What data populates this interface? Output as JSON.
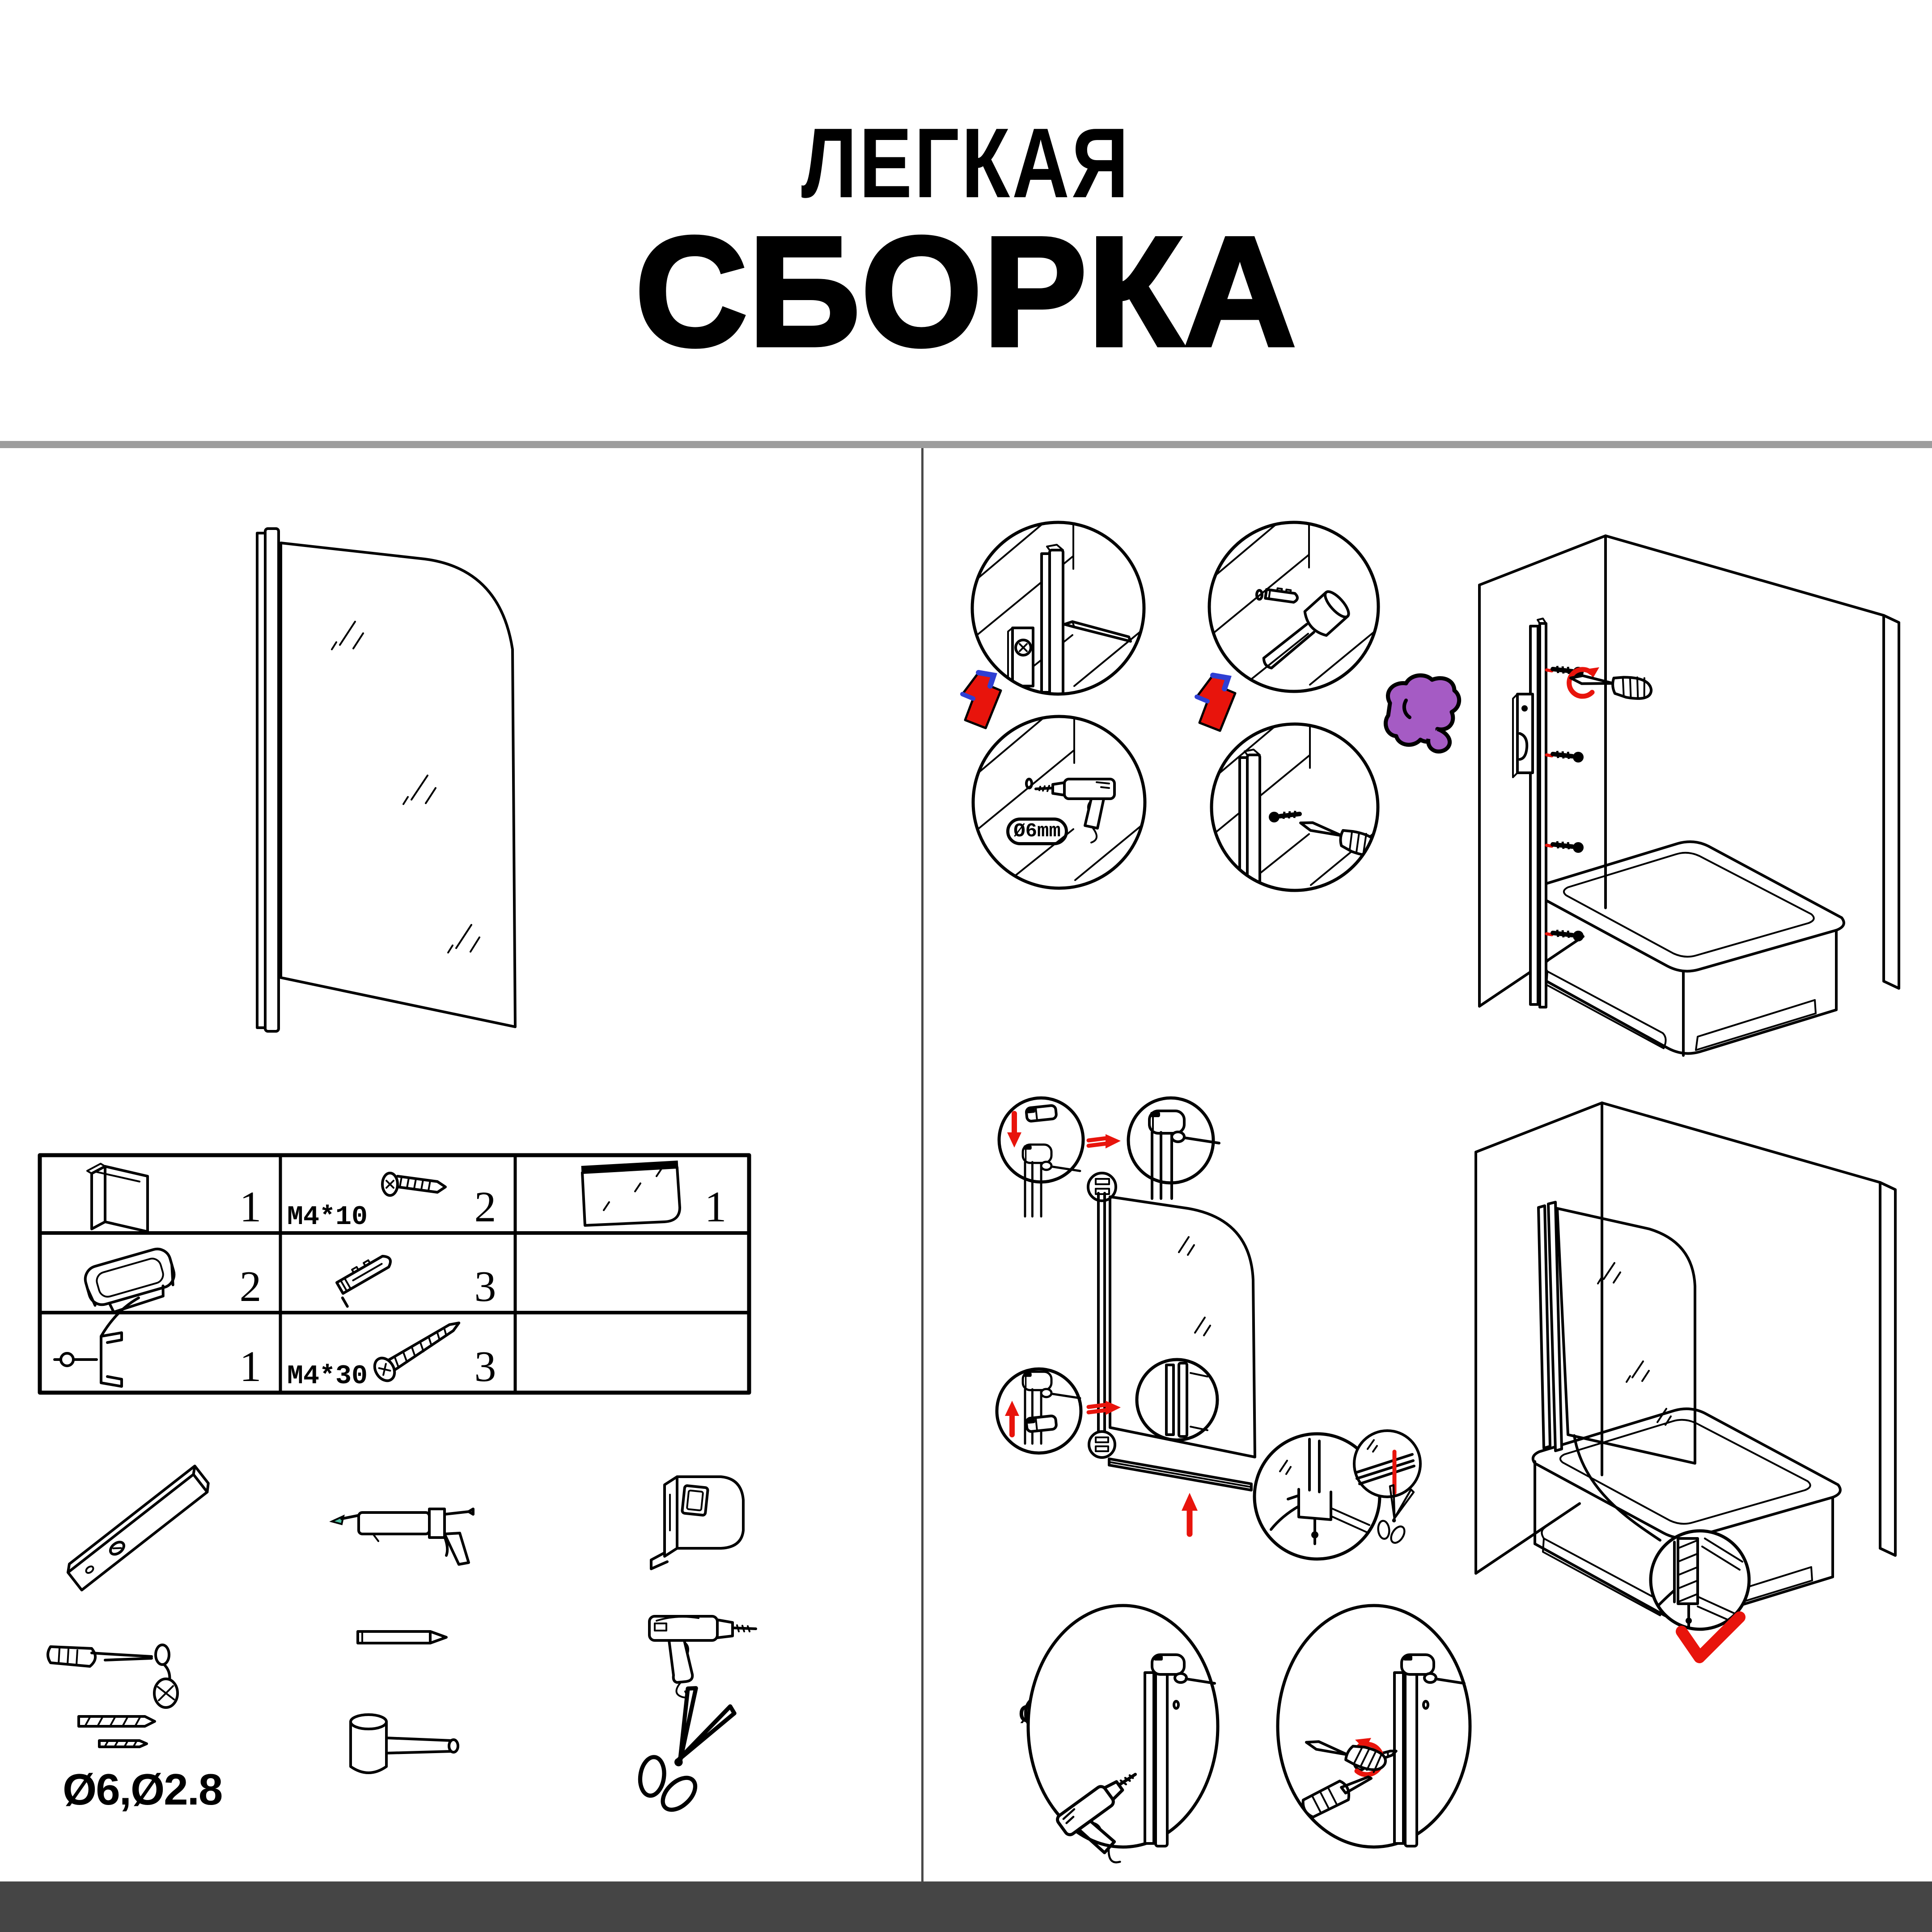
{
  "title": {
    "line1": "ЛЕГКАЯ",
    "line2": "СБОРКА"
  },
  "colors": {
    "ink": "#000000",
    "accent_red": "#e8140c",
    "hand_purple": "#a55bc4",
    "peel_blue": "#2f3fd3",
    "caulk_teal": "#4ec3a4",
    "divider_gray": "#9d9d9d",
    "footer_dark": "#454545"
  },
  "parts_table": {
    "rows": [
      {
        "cells": [
          {
            "item": "wall-profile",
            "qty": "1"
          },
          {
            "item": "screw-short",
            "label": "M4*10",
            "qty": "2"
          },
          {
            "item": "glass-panel",
            "qty": "1"
          }
        ]
      },
      {
        "cells": [
          {
            "item": "hinge-cap",
            "qty": "2"
          },
          {
            "item": "wall-anchor",
            "qty": "3"
          },
          {
            "item": "",
            "qty": ""
          }
        ]
      },
      {
        "cells": [
          {
            "item": "bottom-seal",
            "qty": "1"
          },
          {
            "item": "screw-long",
            "label": "M4*30",
            "qty": "3"
          },
          {
            "item": "",
            "qty": ""
          }
        ]
      }
    ]
  },
  "tools": {
    "drill_bits_label": "Ø6,Ø2.8",
    "items": [
      "spirit-level",
      "caulking-gun",
      "tape-measure",
      "screwdriver",
      "pencil",
      "electric-drill",
      "drill-bits",
      "mallet",
      "scissors"
    ]
  },
  "callouts": {
    "drill_hole": "Ø6mm",
    "pilot_hole": "Ø2.8mm"
  }
}
